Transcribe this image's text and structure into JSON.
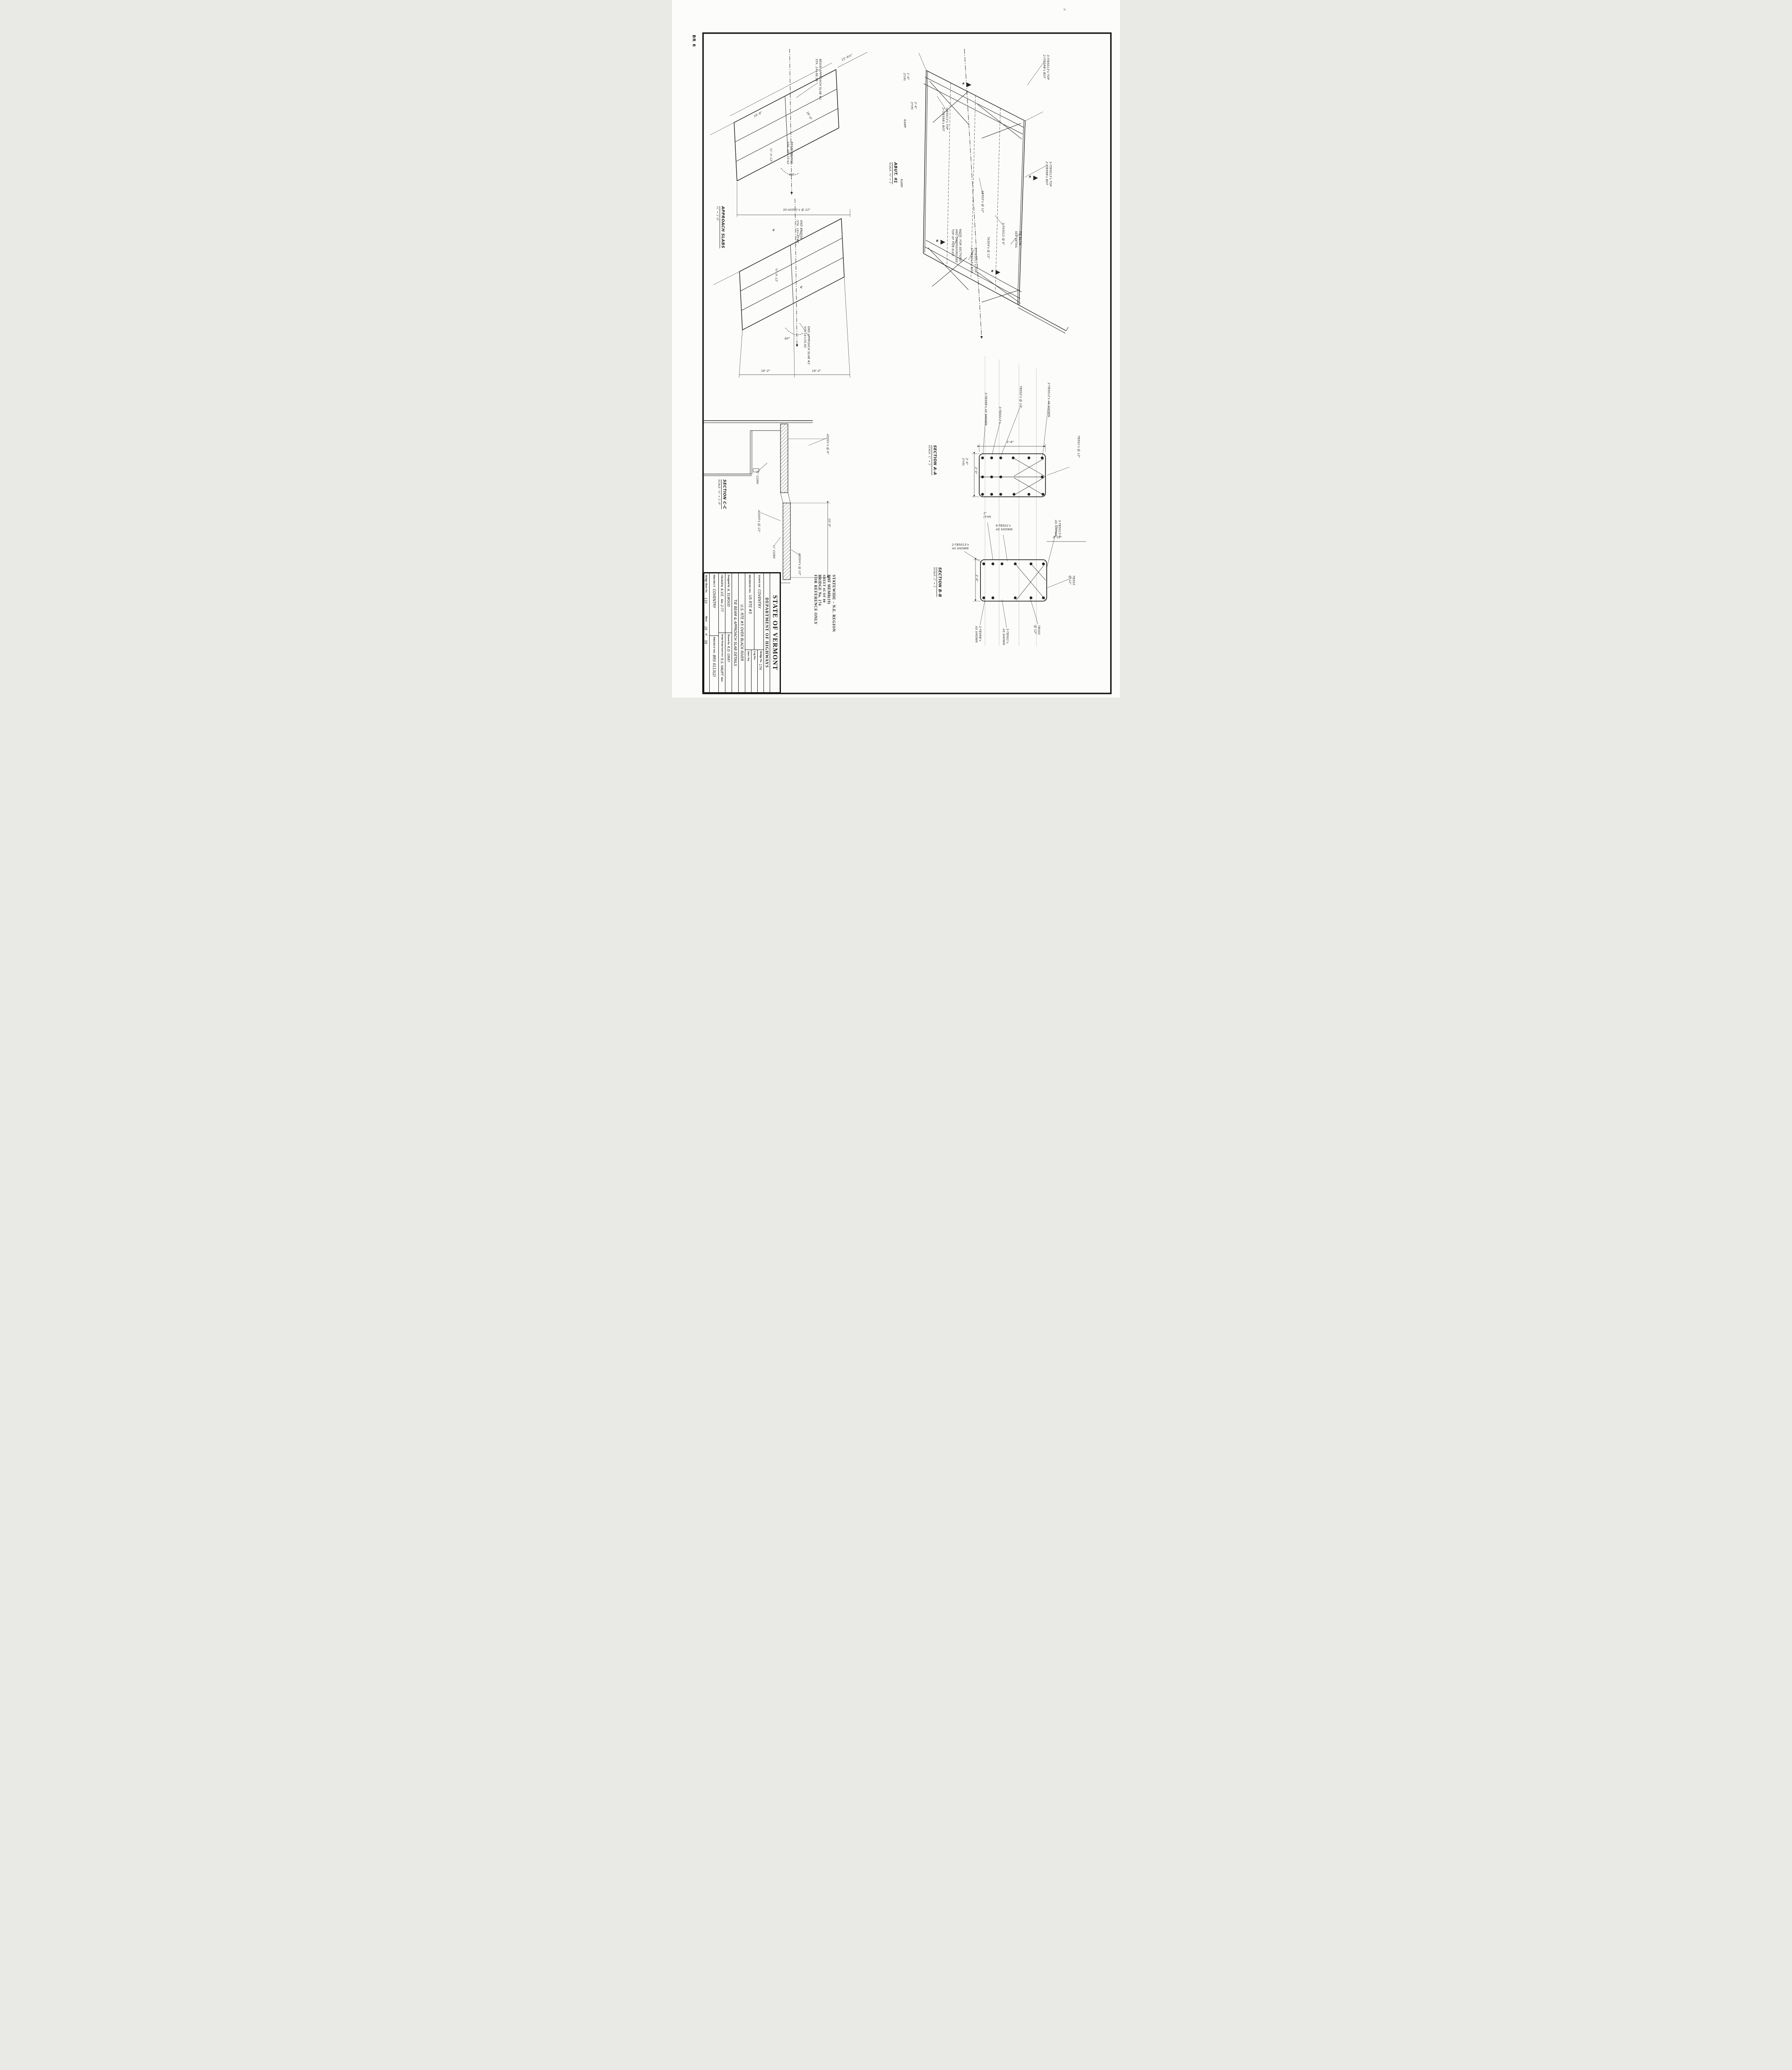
{
  "sheet": {
    "corner_mark": "BR 6",
    "check_mark": "×"
  },
  "stamp": {
    "line1": "STATEWIDE – N.E. REGION",
    "line2": "BHF MEMB(19)",
    "line3": "SHEET 45 OF 80",
    "line4": "BRIDGE No. 174",
    "line5": "FOR REFERENCE ONLY"
  },
  "title_block": {
    "agency": "STATE OF VERMONT",
    "department": "DEPARTMENT OF HIGHWAYS",
    "town_label": "TOWN OF",
    "town": "COVENTRY",
    "bridge_no_label": "Bridge No.",
    "bridge_no": "174",
    "log_sta_label": "Log Sta.",
    "surv_sta_label": "Surv. Sta.",
    "highway_label": "HIGHWAY NO.",
    "highway": "US RTE #5",
    "title1": "U.S. RTE #5 OVER BLACK RIVER",
    "title2": "TIE BEAM & APPROACH SLAB DETAILS",
    "designed_label": "Designed by",
    "designed": "A. ELWOOD",
    "drawn_label": "Drawn by",
    "drawn": "R.D. GRAY",
    "checked_label": "Checked by",
    "checked": "A.V.E.",
    "checked_date_label": "date",
    "checked_date": "2-77",
    "supervisor_label": "Bridge Design Supervisor",
    "supervisor": "R.S. HAUPT",
    "supervisor_date_label": "date",
    "project_label": "PROJECT",
    "project": "COVENTRY",
    "project_no_label": "PROJECT NO.",
    "project_no": "BRS 0113(2)",
    "bridge_sheet_label": "Bridge Sheet No.",
    "bridge_sheet_no": "110",
    "sheet_label": "Sheet",
    "sheet_no": "19",
    "of_label": "of",
    "sheet_total": "58"
  },
  "approach_plan": {
    "title": "APPROACH SLABS",
    "scale": "¾\" = 1'-0\"",
    "labels": {
      "begin_slab1": "BEGIN APPROACH SLAB #1\nSTA. 14+86.58",
      "begin_bridge": "BEGIN BRIDGE\nSTA. 15+10.62",
      "end_bridge": "END BRIDGE\nSTA. 16+41.87",
      "end_slab2": "END APPROACH SLAB #2\nSTA 16+55.92",
      "dim_15_9": "15'-9¼\"",
      "dim_16_8": "16'-8\"",
      "dim_16_0": "16'-0\"",
      "slope1": "¼\" in 12'",
      "slope2": "¼\" in 12'",
      "angle1": "60°",
      "angle2": "60°",
      "bars": "33-AS501's @ 12\"",
      "dim_16_2a": "16'-2\"",
      "dim_16_2b": "16'-2\"",
      "c_marker": "C"
    }
  },
  "bridge_plan": {
    "caption": "ABUT. #1",
    "caption_scale": "SCALE: ¾\" = 1'",
    "flag_a": "A",
    "flag_b": "B",
    "labels": {
      "typ1": "1'-6\"\n(TYP)",
      "typ2": "2'-6\"\n(TYP)",
      "itb_tr": "3-ITB5013's TOP\n2-ITB5RB's BOT",
      "itb_ul": "ITB5013's TOP\n2-ITB5RB's BOT",
      "itb_r": "3-ITB5013's TOP\n2-ITB5RB's BOT",
      "ab503": "AB503's @ 12\"",
      "ta5012": "2-TA5012 @ 6\"",
      "ta504": "TA504's @ 12\"",
      "note": "NOTE: FOR SECTIONS\nAND DIMENSIONS SEE\nTOP OF PILE ELEV.",
      "itb_bl": "3-ITB5011's TOP\n2-ITB5013's BOT",
      "tie_beam": "TIE BEAM\nSEE DETAIL",
      "ramp1": "RAMP",
      "ramp2": "RAMP"
    }
  },
  "section_a": {
    "title": "SECTION A-A",
    "scale": "SCALE: 1\" = 1'",
    "labels": {
      "l1": "3-TB5RB's AS SHOWN",
      "l2": "3-TB5013's",
      "l3": "TB502's @ 12\"",
      "l4": "2-TB5012's AS SHOWN",
      "l5": "TB501's @ 12\"",
      "dim_w": "3'-6\"",
      "dim_h": "2'-0\"",
      "dim_typ": "2'-6\"\n(TYP)"
    }
  },
  "section_b": {
    "title": "SECTION B-B",
    "scale": "SCALE: 1\" = 1'",
    "labels": {
      "typ1": "1\"\n(TYP)",
      "g6": "6-TB501's\nAS SHOWN",
      "d010": "0'-10\"",
      "g2": "2-TB5013's\nAS SHOWN",
      "dim_h": "2'-6\"",
      "g3": "3-TB5013's\nAS SHOWN",
      "tb503": "TB503\n@ 12\"",
      "tb502": "TB502\n@ 12\"",
      "g5": "5-TB501's\nAS SHOWN",
      "g2rb": "2-TB5RB's\nAS SHOWN"
    }
  },
  "section_c": {
    "title": "SECTION C-C",
    "scale": "SCALE: ¾\" = 1'-0\"",
    "labels": {
      "as501": "AS501's @ 6\"",
      "cork1": "½\" CORK",
      "cork2": "¼\" CORK",
      "as505": "AS505's @ 12\"",
      "as504": "AS504's @ 12\"",
      "d10": "10'-0\"",
      "d4": "4'-0\""
    }
  }
}
